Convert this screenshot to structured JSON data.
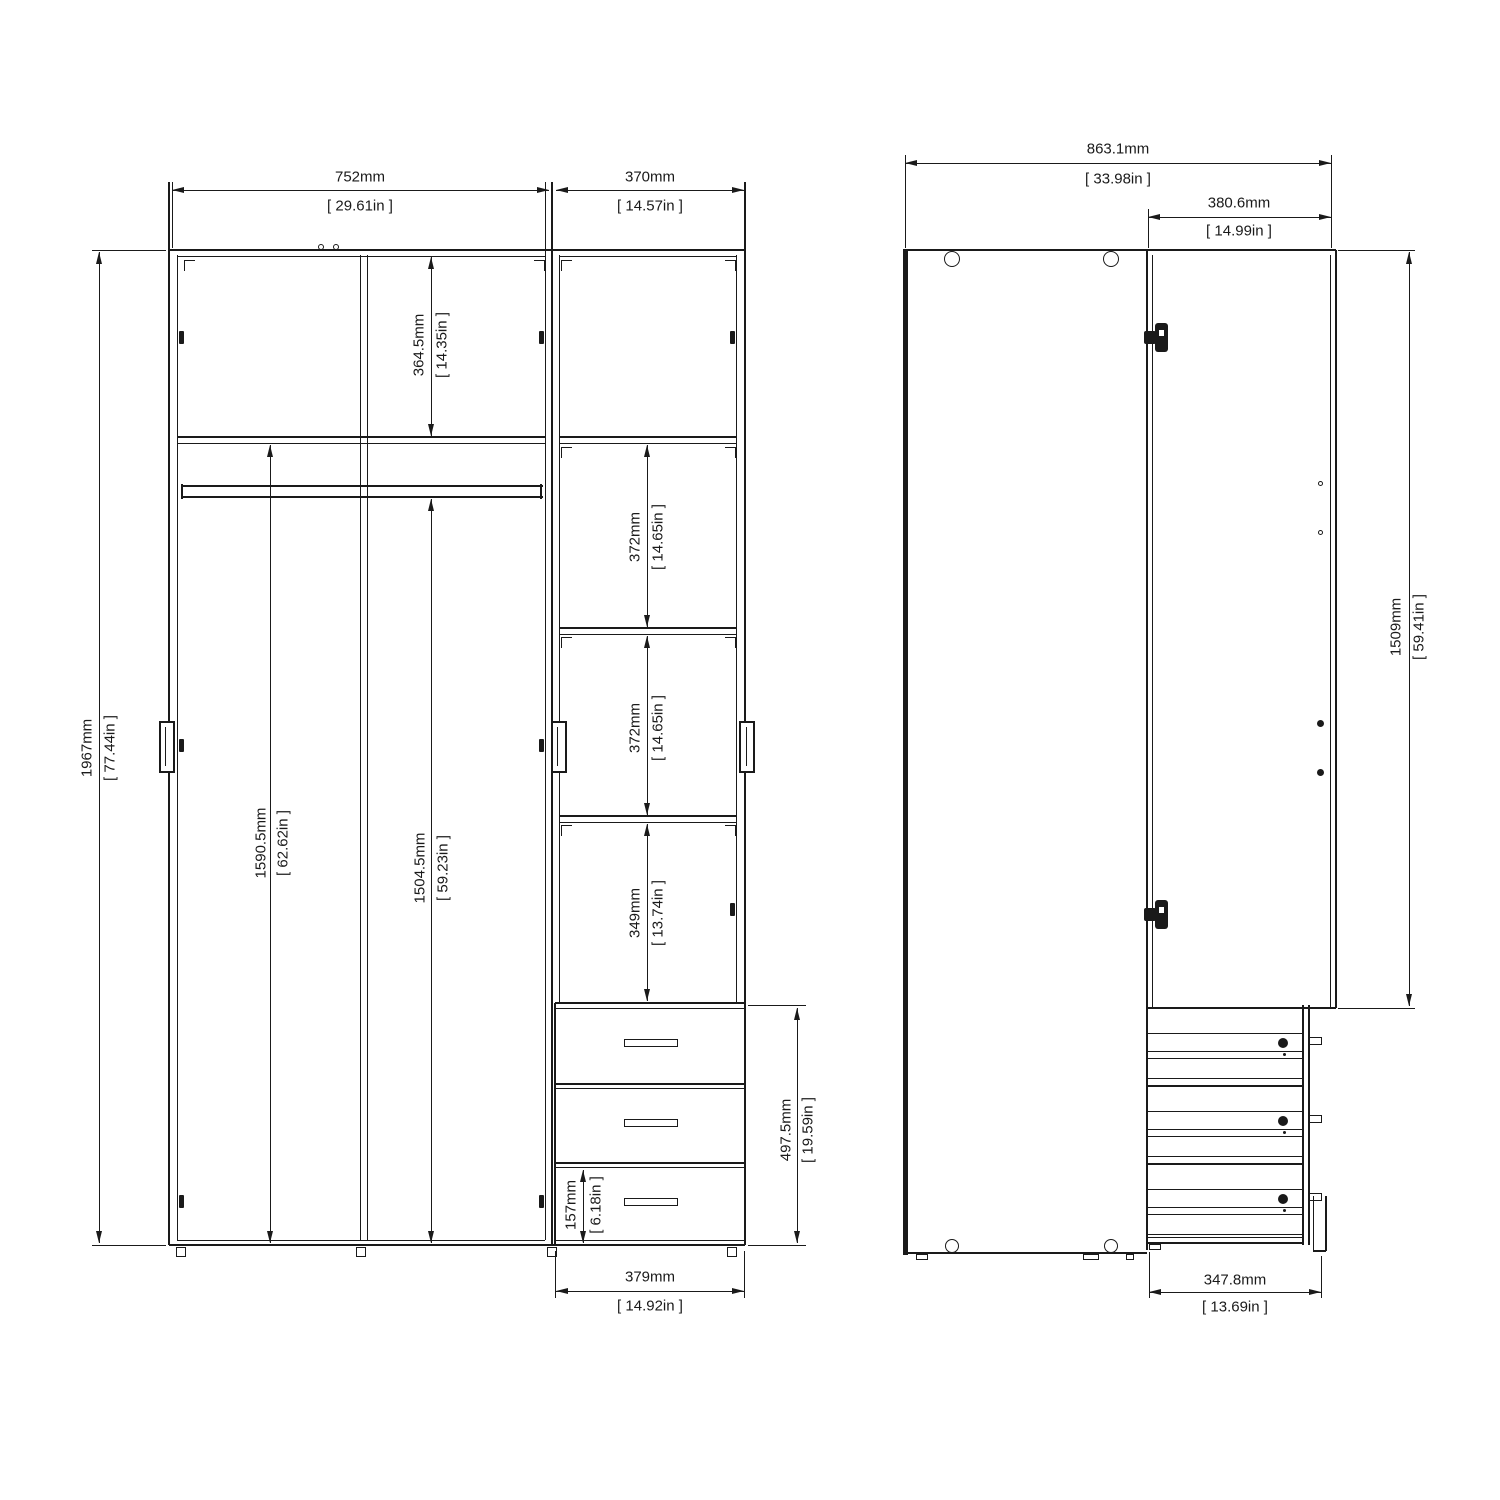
{
  "colors": {
    "line": "#1a1a1a",
    "background": "#ffffff"
  },
  "front_view": {
    "dims": {
      "width_left": {
        "mm": "752mm",
        "in": "[ 29.61in ]"
      },
      "width_right": {
        "mm": "370mm",
        "in": "[ 14.57in ]"
      },
      "top_compartment": {
        "mm": "364.5mm",
        "in": "[ 14.35in ]"
      },
      "total_height": {
        "mm": "1967mm",
        "in": "[ 77.44in ]"
      },
      "left_interior": {
        "mm": "1590.5mm",
        "in": "[ 62.62in ]"
      },
      "rod_to_bottom": {
        "mm": "1504.5mm",
        "in": "[ 59.23in ]"
      },
      "shelf_gap_1": {
        "mm": "372mm",
        "in": "[ 14.65in ]"
      },
      "shelf_gap_2": {
        "mm": "372mm",
        "in": "[ 14.65in ]"
      },
      "shelf_gap_3": {
        "mm": "349mm",
        "in": "[ 13.74in ]"
      },
      "drawer_height": {
        "mm": "157mm",
        "in": "[ 6.18in ]"
      },
      "drawer_section": {
        "mm": "497.5mm",
        "in": "[ 19.59in ]"
      },
      "drawer_width": {
        "mm": "379mm",
        "in": "[ 14.92in ]"
      }
    }
  },
  "side_view": {
    "dims": {
      "total_depth": {
        "mm": "863.1mm",
        "in": "[ 33.98in ]"
      },
      "door_width": {
        "mm": "380.6mm",
        "in": "[ 14.99in ]"
      },
      "door_height": {
        "mm": "1509mm",
        "in": "[ 59.41in ]"
      },
      "drawer_depth": {
        "mm": "347.8mm",
        "in": "[ 13.69in ]"
      }
    }
  }
}
